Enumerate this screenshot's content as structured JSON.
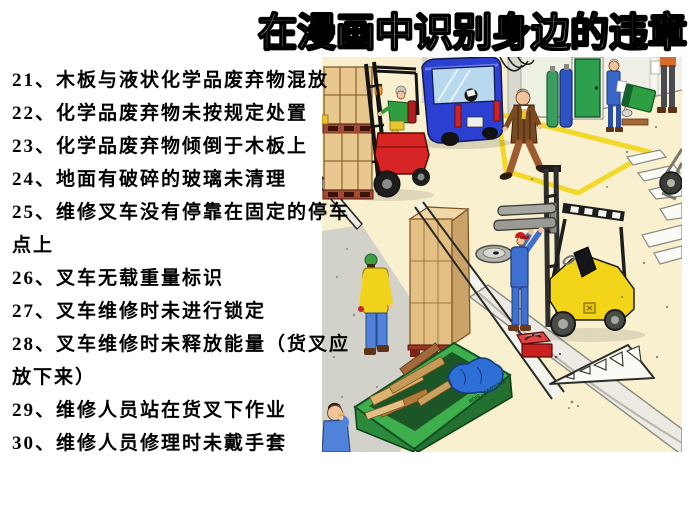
{
  "slide": {
    "title": "在漫画中识别身边的违章",
    "list": {
      "lines": [
        "21、木板与液状化学品废弃物混放",
        "22、化学品废弃物未按规定处置",
        "23、化学品废弃物倾倒于木板上",
        "24、地面有破碎的玻璃未清理",
        "25、维修叉车没有停靠在固定的停车",
        "点上",
        "26、叉车无载重量标识",
        "27、叉车维修时未进行锁定",
        "28、叉车维修时未释放能量（货叉应",
        "放下来）",
        "29、维修人员站在货叉下作业",
        "30、维修人员修理时未戴手套"
      ]
    }
  },
  "illustration": {
    "description": "warehouse safety cartoon: red forklift carrying boxes, blue van, yellow forklift being repaired, green waste dumpster, workers",
    "dumpster_label": "BOIS - CARTONS",
    "colors": {
      "floor": "#f8f0cf",
      "concrete": "#d3d2ca",
      "red_forklift": "#d62524",
      "yellow_forklift": "#f2d418",
      "dumpster_green": "#3fae4c",
      "van_blue": "#2b3fd0",
      "marking_yellow": "#f2d929",
      "door_green": "#2ca04c"
    }
  }
}
